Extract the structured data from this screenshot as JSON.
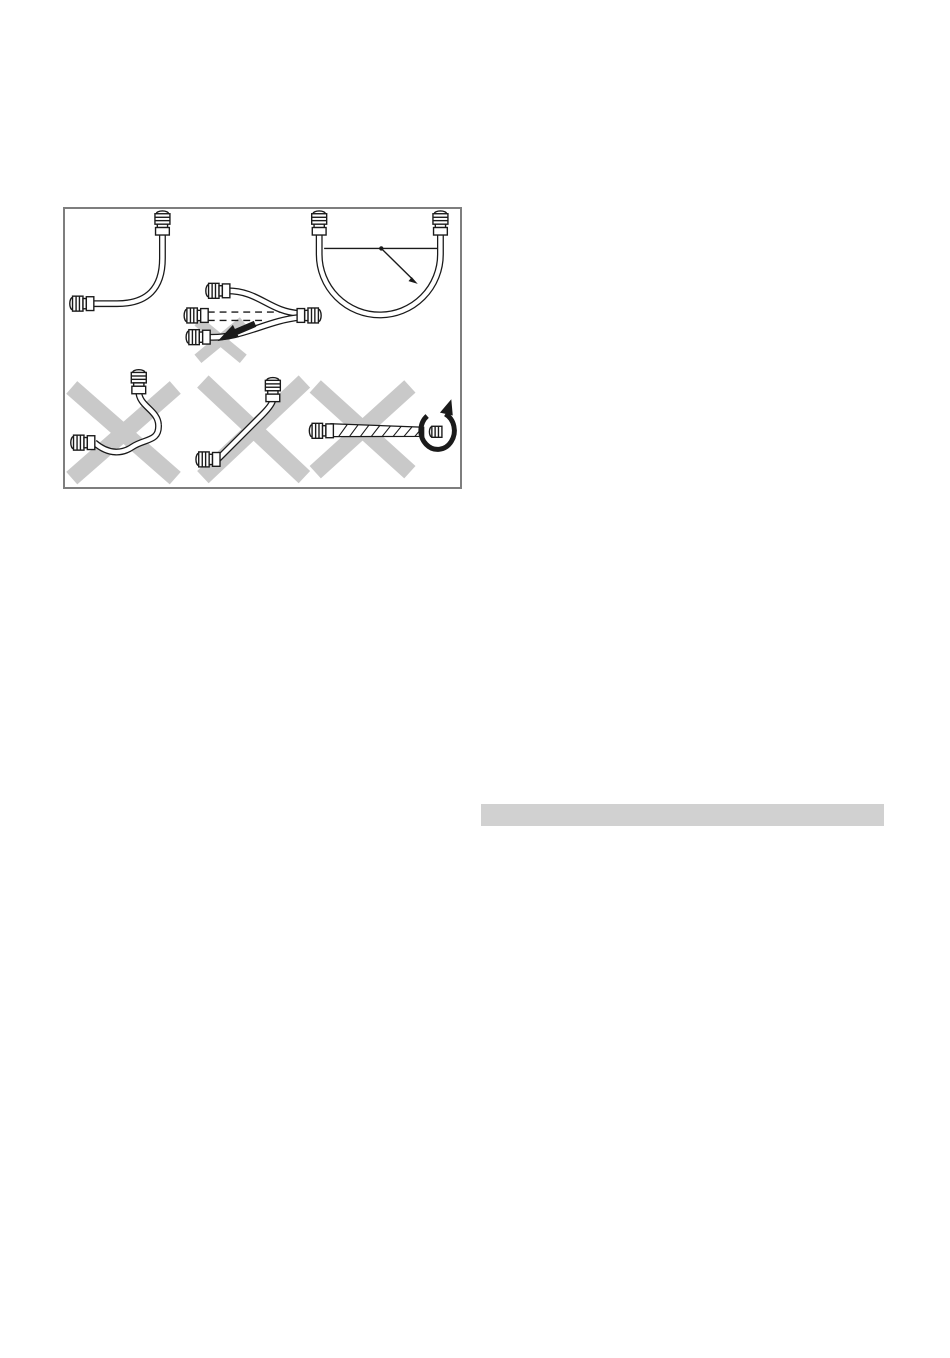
{
  "page": {
    "background": "#ffffff",
    "width": 950,
    "height": 1358
  },
  "figure": {
    "caption": "",
    "border_color": "#7e7e7e",
    "line_color": "#1a1a1a",
    "cross_color": "#c9c9c9",
    "panels": [
      {
        "id": "gentle-90-degree-bend",
        "meaning": "hose routed with a wide 90-degree bend",
        "status": "allowed"
      },
      {
        "id": "pulled-under-tension",
        "meaning": "hose pulled tight / shortens under pressure (dashed original position, pull arrow)",
        "status": "prohibited"
      },
      {
        "id": "minimum-bend-radius",
        "meaning": "u-shaped hose loop with radius arrow marking minimum bend radius",
        "status": "allowed"
      },
      {
        "id": "kinked-hose",
        "meaning": "hose with sharp kink / tight loop",
        "status": "prohibited"
      },
      {
        "id": "stretched-taut",
        "meaning": "hose installed stretched taut in a straight line",
        "status": "prohibited"
      },
      {
        "id": "twisted-hose",
        "meaning": "hose twisted about its axis with rotation arrow",
        "status": "prohibited"
      }
    ]
  },
  "right_column": {
    "heading_bar": {
      "color": "#d1d1d1",
      "text": ""
    }
  }
}
